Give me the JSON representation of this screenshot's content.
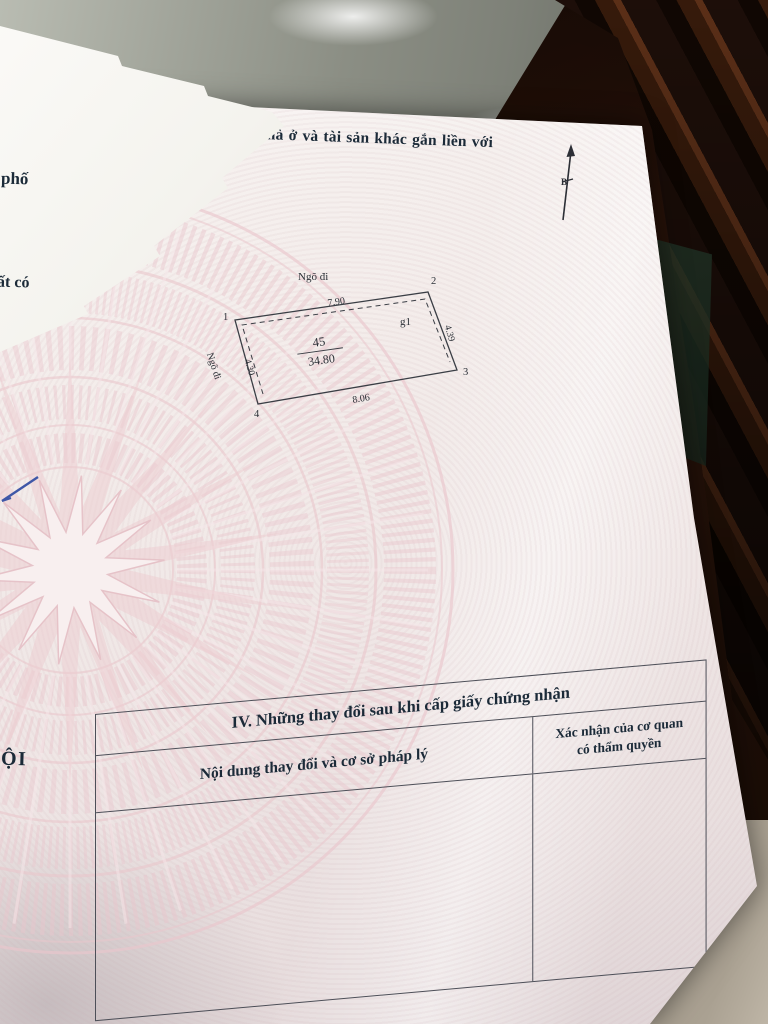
{
  "colors": {
    "paper": "#f3ecea",
    "guilloche": "#e9c6cc",
    "ink": "#1b2a38",
    "table_line": "#4d4f58",
    "wood_dark": "#20100a",
    "wood_light": "#65341a",
    "floor_grey": "#8b8e84",
    "floor_tan": "#aaa192",
    "pen_blue": "#3f57a7"
  },
  "certificate": {
    "section3_title": "III. Sơ đồ thửa đất, nhà ở và tài sản khác gắn liền với đất",
    "edge_fragments": {
      "line1": "phố",
      "line2": "ất có",
      "line3": "ỘI"
    },
    "north_label": "B",
    "diagram": {
      "street_top": "Ngõ đi",
      "street_left": "Ngõ đi",
      "len_top": "7.90",
      "len_bottom": "8.06",
      "len_left": "4.30",
      "len_right": "4.39",
      "plot_no": "45",
      "area": "34.80",
      "annex": "g1",
      "corners": [
        "1",
        "2",
        "3",
        "4"
      ]
    },
    "section4": {
      "title": "IV. Những thay đổi sau khi cấp giấy chứng nhận",
      "col_content": "Nội dung thay đổi và cơ sở pháp lý",
      "col_confirm_line1": "Xác nhận của cơ quan",
      "col_confirm_line2": "có thẩm quyền"
    }
  }
}
